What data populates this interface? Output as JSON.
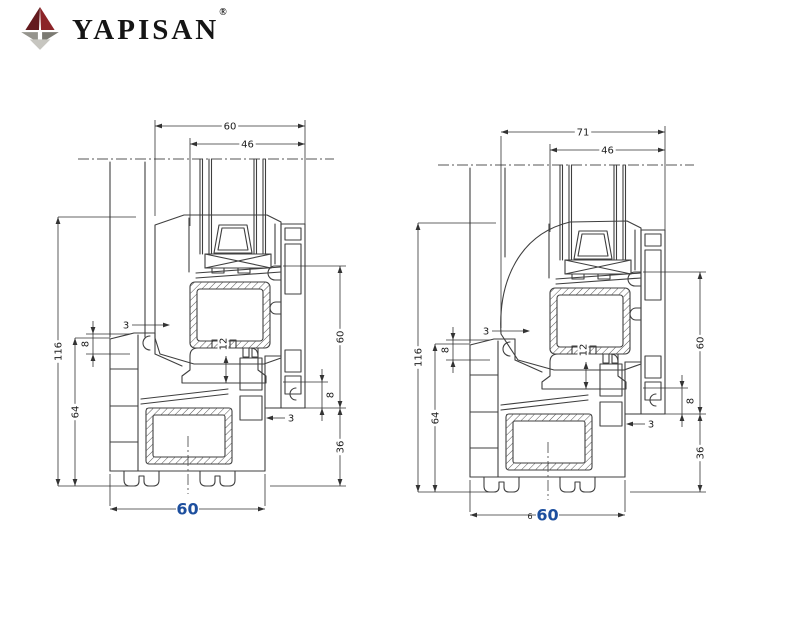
{
  "brand": {
    "name": "YAPISAN",
    "registered": "®"
  },
  "colors": {
    "accent_blue": "#1d4f9e",
    "line": "#3f3f3f",
    "logo_red_dark": "#641a1e",
    "logo_red": "#8c2428",
    "logo_gray_left": "#95948d",
    "logo_gray_right": "#7b7a72",
    "logo_gray_bottom": "#c7c6c0"
  },
  "drawings": [
    {
      "id": "left",
      "style": "angular",
      "title": "window profile section 1",
      "dims": {
        "top_width": "60",
        "glazing_width": "46",
        "total_height": "116",
        "frame_height": "64",
        "left_gap": "8",
        "left_wall": "3",
        "steel_depth": "12",
        "right_height": "60",
        "right_gap": "8",
        "right_wall": "3",
        "lower_height": "36",
        "bottom_width": "60",
        "bottom_prefix": ""
      }
    },
    {
      "id": "right",
      "style": "rounded",
      "title": "window profile section 2",
      "dims": {
        "top_width": "71",
        "glazing_width": "46",
        "total_height": "116",
        "frame_height": "64",
        "left_gap": "8",
        "left_wall": "3",
        "steel_depth": "12",
        "right_height": "60",
        "right_gap": "8",
        "right_wall": "3",
        "lower_height": "36",
        "bottom_width": "60",
        "bottom_prefix": "6"
      }
    }
  ]
}
